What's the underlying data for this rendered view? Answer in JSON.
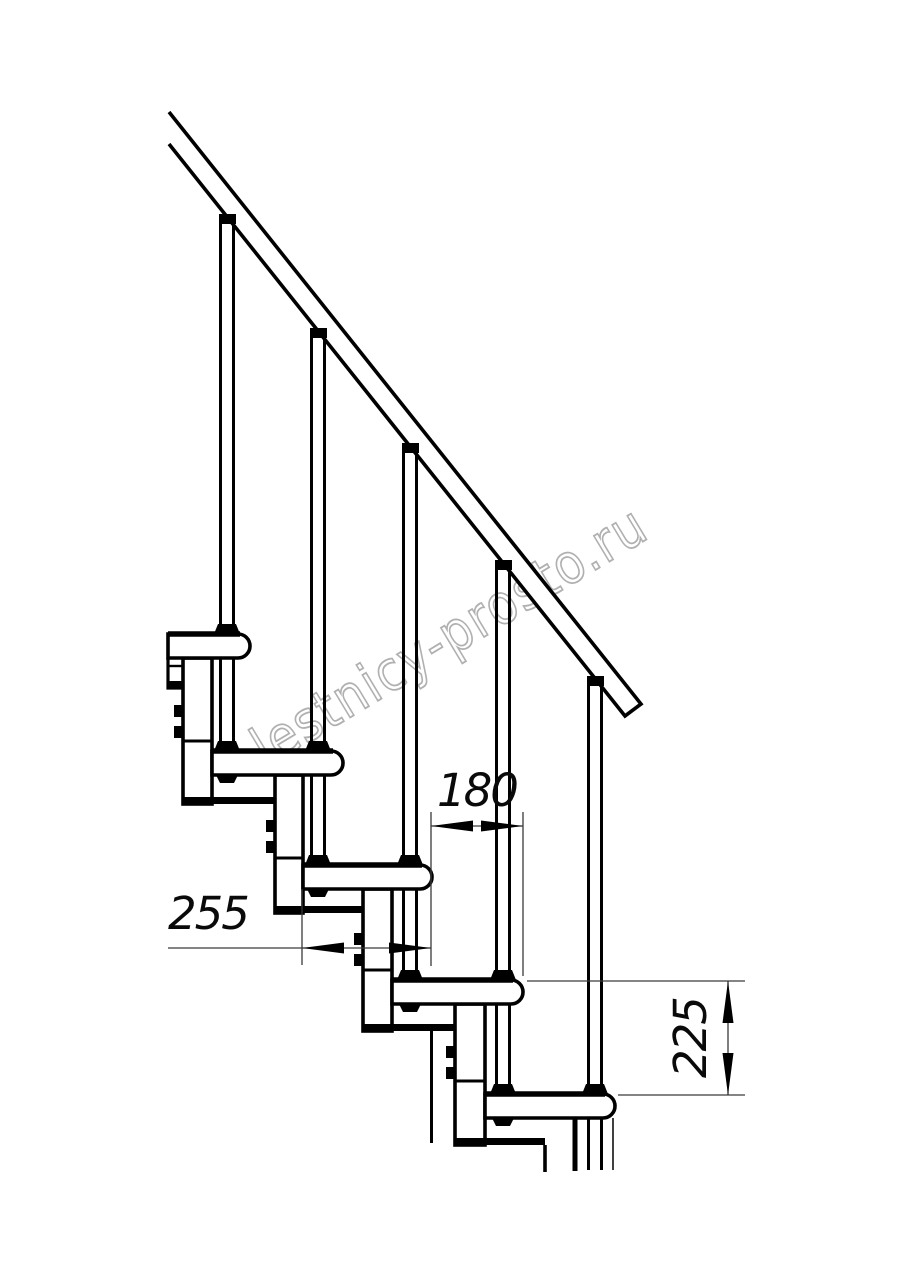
{
  "drawing": {
    "title": "modular staircase side elevation",
    "watermark": {
      "text": "lestnicy-prosto.ru",
      "color": "#b0b0b0"
    },
    "dimensions": [
      {
        "id": "dim-255",
        "value": "255"
      },
      {
        "id": "dim-180",
        "value": "180"
      },
      {
        "id": "dim-225",
        "value": "225"
      }
    ],
    "colors": {
      "background": "#ffffff",
      "line": "#000000",
      "dimension_line": "#3a3a3a",
      "dimension_text": "#0a0a0a"
    }
  }
}
